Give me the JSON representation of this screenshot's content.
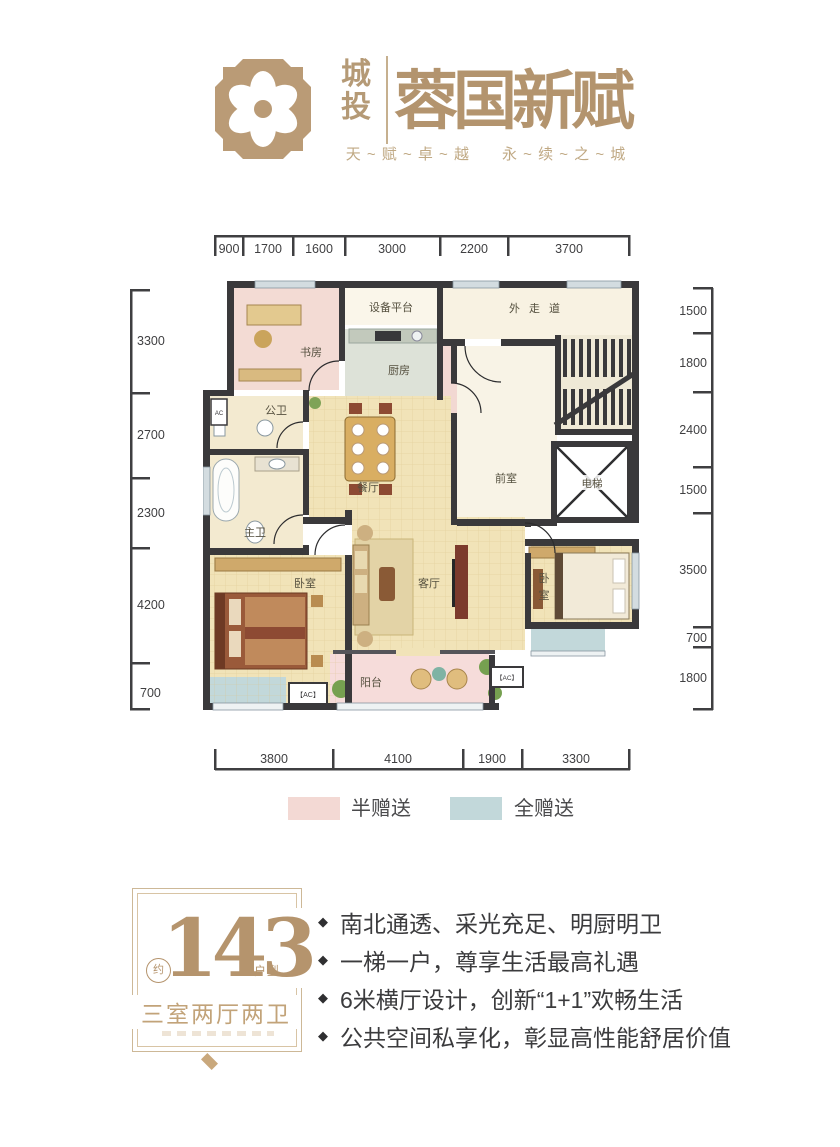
{
  "header": {
    "brand_cn": "城投",
    "brand_name": "蓉国新赋",
    "tagline": "天 ~ 赋 ~ 卓 ~ 越　　永 ~ 续 ~ 之 ~ 城"
  },
  "dimensions": {
    "top": [
      "900",
      "1700",
      "1600",
      "3000",
      "2200",
      "3700"
    ],
    "bottom": [
      "3800",
      "4100",
      "1900",
      "3300"
    ],
    "left": [
      "3300",
      "2700",
      "2300",
      "4200",
      "700"
    ],
    "right": [
      "1500",
      "1800",
      "2400",
      "1500",
      "3500",
      "700",
      "1800"
    ]
  },
  "floorplan": {
    "rooms": {
      "study": "书房",
      "equipment": "设备平台",
      "kitchen": "厨房",
      "corridor": "外走道",
      "public_bath": "公卫",
      "dining": "餐厅",
      "front_room": "前室",
      "elevator": "电梯",
      "master_bath": "主卫",
      "bedroom_left": "卧室",
      "living": "客厅",
      "bedroom_right_l1": "卧",
      "bedroom_right_l2": "室",
      "balcony": "阳台",
      "ac_label": "【AC】",
      "ac_small": "AC"
    }
  },
  "legend": {
    "half": {
      "label": "半赠送",
      "color": "#f3d9d4"
    },
    "full": {
      "label": "全赠送",
      "color": "#c2d8da"
    }
  },
  "badge": {
    "approx": "约",
    "number": "143",
    "suffix": "户型",
    "layout": "三室两厅两卫"
  },
  "bullet": "◆",
  "features": [
    "南北通透、采光充足、明厨明卫",
    "一梯一户，尊享生活最高礼遇",
    "6米横厅设计，创新“1+1”欢畅生活",
    "公共空间私享化，彰显高性能舒居价值"
  ],
  "colors": {
    "brand_tan": "#b59a76",
    "wall": "#3a393b",
    "floor_cream": "#f1e3b8",
    "gift_half_pink": "#f3d9d4",
    "gift_full_teal": "#c2d8da",
    "dim_line": "#3f3f41",
    "badge_text": "#b5946d"
  }
}
